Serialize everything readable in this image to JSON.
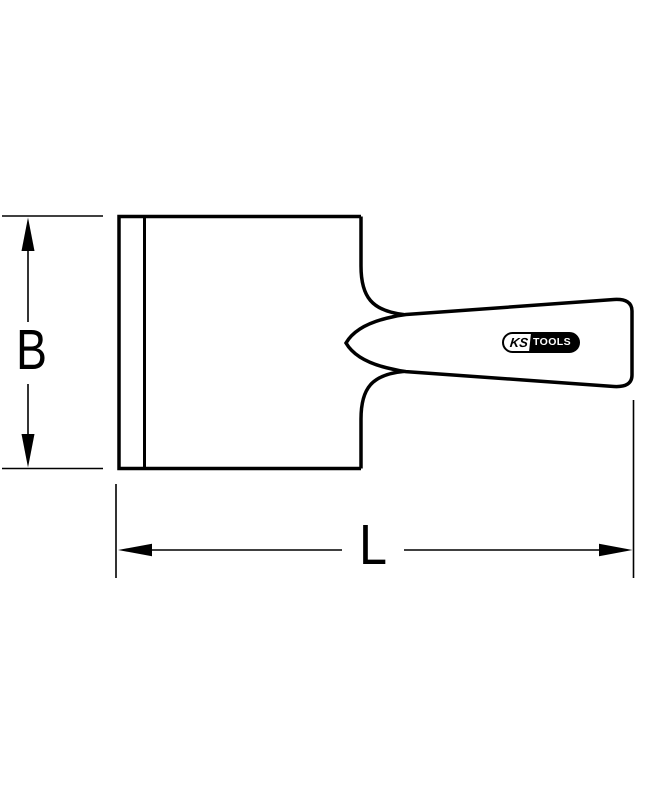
{
  "drawing": {
    "background": "#ffffff",
    "stroke_color": "#000000",
    "labels": {
      "height": "B",
      "length": "L"
    },
    "logo": {
      "left": "KS",
      "right": "TOOLS",
      "bg": "#000000",
      "fg": "#ffffff"
    }
  }
}
